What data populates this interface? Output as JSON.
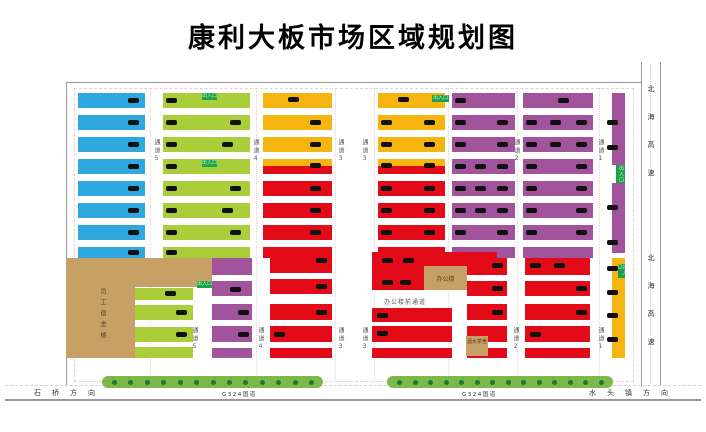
{
  "title": "康利大板市场区域规划图",
  "colors": {
    "B": "#2FA8DF",
    "G": "#A9CE39",
    "O": "#F6B40E",
    "R": "#E30B17",
    "P": "#A1549C",
    "T": "#C7A065",
    "tag": "#1BA14B",
    "tree": "#7CB94A",
    "treeDot": "#1E7A30",
    "mark": "#111111",
    "line": "#9a9a9a"
  },
  "map": {
    "bars": [
      [
        78,
        93,
        67,
        15,
        "B"
      ],
      [
        78,
        115,
        67,
        15,
        "B"
      ],
      [
        78,
        137,
        67,
        15,
        "B"
      ],
      [
        78,
        159,
        67,
        15,
        "B"
      ],
      [
        78,
        181,
        67,
        15,
        "B"
      ],
      [
        78,
        203,
        67,
        15,
        "B"
      ],
      [
        78,
        225,
        67,
        15,
        "B"
      ],
      [
        78,
        247,
        67,
        11,
        "B"
      ],
      [
        163,
        93,
        87,
        15,
        "G"
      ],
      [
        163,
        115,
        87,
        15,
        "G"
      ],
      [
        163,
        137,
        87,
        15,
        "G"
      ],
      [
        163,
        159,
        87,
        15,
        "G"
      ],
      [
        163,
        181,
        87,
        15,
        "G"
      ],
      [
        163,
        203,
        87,
        15,
        "G"
      ],
      [
        163,
        225,
        87,
        15,
        "G"
      ],
      [
        163,
        247,
        87,
        11,
        "G"
      ],
      [
        263,
        93,
        69,
        15,
        "O"
      ],
      [
        263,
        115,
        69,
        15,
        "O"
      ],
      [
        263,
        137,
        69,
        15,
        "O"
      ],
      [
        263,
        159,
        69,
        7,
        "O"
      ],
      [
        263,
        166,
        69,
        8,
        "R"
      ],
      [
        263,
        181,
        69,
        15,
        "R"
      ],
      [
        263,
        203,
        69,
        15,
        "R"
      ],
      [
        263,
        225,
        69,
        15,
        "R"
      ],
      [
        263,
        247,
        69,
        11,
        "R"
      ],
      [
        378,
        93,
        67,
        15,
        "O"
      ],
      [
        378,
        115,
        67,
        15,
        "O"
      ],
      [
        378,
        137,
        67,
        15,
        "O"
      ],
      [
        378,
        159,
        67,
        7,
        "O"
      ],
      [
        378,
        166,
        67,
        8,
        "R"
      ],
      [
        378,
        181,
        67,
        15,
        "R"
      ],
      [
        378,
        203,
        67,
        15,
        "R"
      ],
      [
        378,
        225,
        67,
        15,
        "R"
      ],
      [
        378,
        247,
        67,
        11,
        "R"
      ],
      [
        452,
        93,
        63,
        15,
        "P"
      ],
      [
        452,
        115,
        63,
        15,
        "P"
      ],
      [
        452,
        137,
        63,
        15,
        "P"
      ],
      [
        452,
        159,
        63,
        15,
        "P"
      ],
      [
        452,
        181,
        63,
        15,
        "P"
      ],
      [
        452,
        203,
        63,
        15,
        "P"
      ],
      [
        452,
        225,
        63,
        15,
        "P"
      ],
      [
        452,
        247,
        63,
        11,
        "P"
      ],
      [
        523,
        93,
        70,
        15,
        "P"
      ],
      [
        523,
        115,
        70,
        15,
        "P"
      ],
      [
        523,
        137,
        70,
        15,
        "P"
      ],
      [
        523,
        159,
        70,
        15,
        "P"
      ],
      [
        523,
        181,
        70,
        15,
        "P"
      ],
      [
        523,
        203,
        70,
        15,
        "P"
      ],
      [
        523,
        225,
        70,
        15,
        "P"
      ],
      [
        523,
        247,
        70,
        11,
        "P"
      ],
      [
        612,
        93,
        13,
        72,
        "P"
      ],
      [
        612,
        183,
        13,
        70,
        "P"
      ],
      [
        135,
        288,
        58,
        12,
        "G"
      ],
      [
        135,
        305,
        58,
        15,
        "G"
      ],
      [
        135,
        327,
        58,
        15,
        "G"
      ],
      [
        135,
        347,
        58,
        11,
        "G"
      ],
      [
        212,
        258,
        40,
        17,
        "P"
      ],
      [
        212,
        281,
        40,
        15,
        "P"
      ],
      [
        212,
        304,
        40,
        16,
        "P"
      ],
      [
        212,
        326,
        40,
        16,
        "P"
      ],
      [
        212,
        348,
        40,
        10,
        "P"
      ],
      [
        270,
        252,
        62,
        21,
        "R"
      ],
      [
        270,
        279,
        62,
        15,
        "R"
      ],
      [
        270,
        304,
        62,
        16,
        "R"
      ],
      [
        270,
        326,
        62,
        16,
        "R"
      ],
      [
        270,
        348,
        62,
        10,
        "R"
      ],
      [
        372,
        252,
        125,
        21,
        "R"
      ],
      [
        372,
        273,
        52,
        17,
        "R"
      ],
      [
        372,
        308,
        80,
        14,
        "R"
      ],
      [
        372,
        326,
        80,
        16,
        "R"
      ],
      [
        372,
        348,
        80,
        10,
        "R"
      ],
      [
        467,
        258,
        40,
        17,
        "R"
      ],
      [
        467,
        281,
        40,
        15,
        "R"
      ],
      [
        467,
        304,
        40,
        16,
        "R"
      ],
      [
        467,
        326,
        40,
        16,
        "R"
      ],
      [
        467,
        348,
        40,
        10,
        "R"
      ],
      [
        525,
        258,
        65,
        17,
        "R"
      ],
      [
        525,
        281,
        65,
        15,
        "R"
      ],
      [
        525,
        304,
        65,
        16,
        "R"
      ],
      [
        525,
        326,
        65,
        16,
        "R"
      ],
      [
        525,
        348,
        65,
        10,
        "R"
      ],
      [
        612,
        258,
        13,
        100,
        "O"
      ]
    ],
    "marks": [
      [
        128,
        98
      ],
      [
        128,
        120
      ],
      [
        128,
        142
      ],
      [
        128,
        164
      ],
      [
        128,
        186
      ],
      [
        128,
        208
      ],
      [
        128,
        230
      ],
      [
        128,
        250
      ],
      [
        166,
        98
      ],
      [
        166,
        120
      ],
      [
        230,
        120
      ],
      [
        166,
        142
      ],
      [
        222,
        142
      ],
      [
        166,
        164
      ],
      [
        166,
        186
      ],
      [
        230,
        186
      ],
      [
        166,
        208
      ],
      [
        222,
        208
      ],
      [
        166,
        230
      ],
      [
        230,
        230
      ],
      [
        166,
        250
      ],
      [
        288,
        97
      ],
      [
        310,
        120
      ],
      [
        310,
        142
      ],
      [
        310,
        163
      ],
      [
        310,
        186
      ],
      [
        310,
        208
      ],
      [
        310,
        230
      ],
      [
        398,
        97
      ],
      [
        381,
        120
      ],
      [
        424,
        120
      ],
      [
        381,
        142
      ],
      [
        424,
        142
      ],
      [
        381,
        163
      ],
      [
        424,
        163
      ],
      [
        381,
        186
      ],
      [
        424,
        186
      ],
      [
        381,
        208
      ],
      [
        424,
        208
      ],
      [
        381,
        230
      ],
      [
        424,
        230
      ],
      [
        455,
        98
      ],
      [
        455,
        120
      ],
      [
        497,
        120
      ],
      [
        455,
        142
      ],
      [
        497,
        142
      ],
      [
        455,
        164
      ],
      [
        475,
        164
      ],
      [
        497,
        164
      ],
      [
        455,
        186
      ],
      [
        475,
        186
      ],
      [
        497,
        186
      ],
      [
        455,
        208
      ],
      [
        475,
        208
      ],
      [
        497,
        208
      ],
      [
        455,
        230
      ],
      [
        497,
        230
      ],
      [
        558,
        98
      ],
      [
        526,
        120
      ],
      [
        550,
        120
      ],
      [
        576,
        120
      ],
      [
        526,
        142
      ],
      [
        550,
        142
      ],
      [
        576,
        142
      ],
      [
        526,
        164
      ],
      [
        576,
        164
      ],
      [
        526,
        186
      ],
      [
        576,
        186
      ],
      [
        526,
        208
      ],
      [
        576,
        208
      ],
      [
        526,
        230
      ],
      [
        576,
        230
      ],
      [
        607,
        120
      ],
      [
        607,
        145
      ],
      [
        607,
        205
      ],
      [
        607,
        240
      ],
      [
        165,
        291
      ],
      [
        176,
        310
      ],
      [
        176,
        332
      ],
      [
        230,
        287
      ],
      [
        238,
        310
      ],
      [
        238,
        332
      ],
      [
        316,
        258
      ],
      [
        316,
        284
      ],
      [
        316,
        310
      ],
      [
        274,
        332
      ],
      [
        382,
        258
      ],
      [
        403,
        258
      ],
      [
        382,
        280
      ],
      [
        400,
        280
      ],
      [
        377,
        313
      ],
      [
        377,
        331
      ],
      [
        492,
        263
      ],
      [
        492,
        286
      ],
      [
        492,
        310
      ],
      [
        530,
        263
      ],
      [
        554,
        263
      ],
      [
        576,
        286
      ],
      [
        576,
        310
      ],
      [
        530,
        332
      ],
      [
        607,
        266
      ],
      [
        607,
        290
      ],
      [
        607,
        313
      ],
      [
        607,
        337
      ]
    ],
    "tags": {
      "text": "出入口",
      "items": [
        [
          202,
          93,
          15,
          7,
          0
        ],
        [
          202,
          160,
          15,
          7,
          0
        ],
        [
          432,
          95,
          17,
          7,
          0
        ],
        [
          197,
          281,
          15,
          7,
          0
        ],
        [
          616,
          165,
          9,
          18,
          1
        ],
        [
          618,
          264,
          7,
          14,
          1
        ]
      ]
    },
    "aisles": [
      {
        "t": "通道5",
        "x": 152,
        "y": 139
      },
      {
        "t": "通道4",
        "x": 251,
        "y": 139
      },
      {
        "t": "通道3",
        "x": 336,
        "y": 139
      },
      {
        "t": "通道3",
        "x": 360,
        "y": 139
      },
      {
        "t": "通道2",
        "x": 512,
        "y": 139
      },
      {
        "t": "通道1",
        "x": 596,
        "y": 139
      },
      {
        "t": "通道5",
        "x": 190,
        "y": 327
      },
      {
        "t": "通道4",
        "x": 256,
        "y": 327
      },
      {
        "t": "通道3",
        "x": 336,
        "y": 327
      },
      {
        "t": "通道3",
        "x": 360,
        "y": 327
      },
      {
        "t": "通道2",
        "x": 511,
        "y": 327
      },
      {
        "t": "通道1",
        "x": 596,
        "y": 327
      }
    ],
    "buildings": [
      {
        "name": "员工宿舍楼",
        "rects": [
          [
            66,
            258,
            146,
            29
          ],
          [
            66,
            287,
            69,
            71
          ]
        ],
        "label": {
          "x": 98,
          "y": 288,
          "v": 1,
          "wrap": 0
        }
      },
      {
        "name": "办公楼",
        "rects": [
          [
            424,
            266,
            43,
            24
          ]
        ],
        "label": {
          "x": 424,
          "y": 274,
          "v": 0,
          "w": 43,
          "wrap": 0
        }
      },
      {
        "name": "酒水茶舍",
        "rects": [
          [
            466,
            336,
            22,
            20
          ]
        ],
        "label": {
          "x": 467,
          "y": 339,
          "v": 0,
          "w": 20,
          "wrap": 1
        }
      }
    ],
    "texts": [
      {
        "t": "办公楼前通道",
        "x": 384,
        "y": 297
      }
    ],
    "lines": [
      [
        66,
        82,
        575,
        1
      ],
      [
        66,
        82,
        1,
        303
      ],
      [
        641,
        62,
        1,
        324
      ],
      [
        660,
        62,
        1,
        324
      ],
      [
        5,
        399,
        696,
        2
      ]
    ],
    "dash_h": [
      [
        5,
        385,
        696
      ]
    ],
    "dot_v": [
      [
        650,
        64,
        322
      ]
    ],
    "guides_v": [
      150,
      256,
      335,
      374,
      448,
      517,
      599
    ],
    "guide_rect": [
      74,
      88,
      558,
      292
    ]
  },
  "roads": {
    "bottom": {
      "left_direction": "石桥方向",
      "road_name": "G324国道",
      "right_direction": "水头镇方向",
      "left_pos": [
        34,
        388
      ],
      "right_pos": [
        589,
        388
      ],
      "name_positions": [
        [
          222,
          390
        ],
        [
          462,
          390
        ]
      ],
      "trees": [
        [
          102,
          376,
          221,
          12,
          13
        ],
        [
          387,
          376,
          226,
          12,
          14
        ]
      ]
    },
    "highway": {
      "name": "北海高速",
      "positions": [
        [
          646,
          85
        ],
        [
          646,
          254
        ]
      ]
    }
  }
}
